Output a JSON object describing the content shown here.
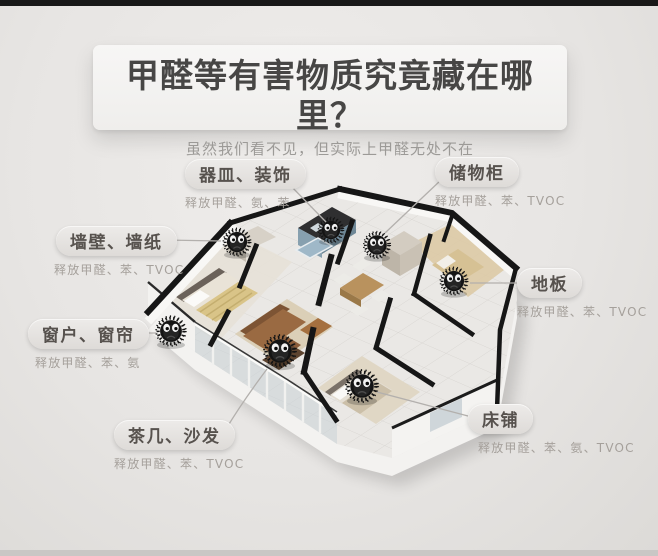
{
  "header": {
    "title": "甲醛等有害物质究竟藏在哪里？",
    "subtitle": "虽然我们看不见，但实际上甲醛无处不在"
  },
  "labels": {
    "vessels": {
      "title": "器皿、装饰",
      "sub": "释放甲醛、氨、苯"
    },
    "cabinet": {
      "title": "储物柜",
      "sub": "释放甲醛、苯、TVOC"
    },
    "wall": {
      "title": "墙壁、墙纸",
      "sub": "释放甲醛、苯、TVOC"
    },
    "floor": {
      "title": "地板",
      "sub": "释放甲醛、苯、TVOC"
    },
    "window": {
      "title": "窗户、窗帘",
      "sub": "释放甲醛、苯、氨"
    },
    "sofa": {
      "title": "茶几、沙发",
      "sub": "释放甲醛、苯、TVOC"
    },
    "bed": {
      "title": "床铺",
      "sub": "释放甲醛、苯、氨、TVOC"
    }
  },
  "colors": {
    "top_bar": "#181818",
    "title_text": "#474645",
    "subtitle_text": "#9c9a97",
    "label_text": "#57524e",
    "sub_text": "#a5a09b",
    "monster_body": "#141414"
  }
}
